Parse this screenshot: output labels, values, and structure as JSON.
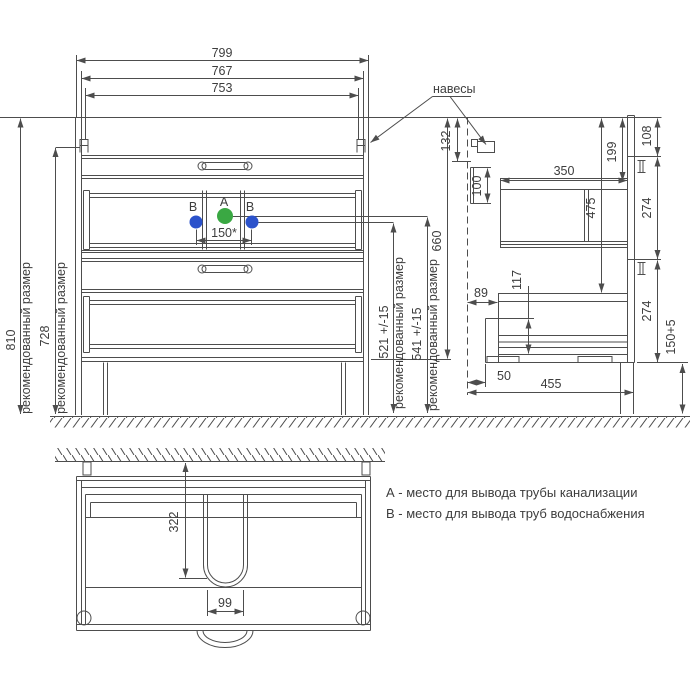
{
  "front": {
    "w_799": "799",
    "w_767": "767",
    "w_753": "753",
    "h_810": "810",
    "h_728": "728",
    "rec_note": "рекомендованный размер",
    "b_521": "521 +/-15",
    "a_541": "541 +/-15",
    "h_660": "660",
    "span_150": "150*",
    "pipe_a_label": "А",
    "pipe_b_label": "В"
  },
  "side": {
    "hangers_label": "навесы",
    "d_132": "132",
    "d_100": "100",
    "d_350": "350",
    "d_199": "199",
    "d_475": "475",
    "d_108": "108",
    "d_274_top": "274",
    "d_274_bottom": "274",
    "d_89": "89",
    "d_117": "117",
    "d_50": "50",
    "d_455": "455",
    "d_150_5": "150+5"
  },
  "top_view": {
    "d_322": "322",
    "d_99": "99"
  },
  "legend": {
    "line_a": "А - место для вывода трубы канализации",
    "line_b": "В - место для вывода труб водоснабжения"
  },
  "colors": {
    "line": "#4d4d4d",
    "pipe_a": "#3aa843",
    "pipe_b": "#2b52cb"
  }
}
